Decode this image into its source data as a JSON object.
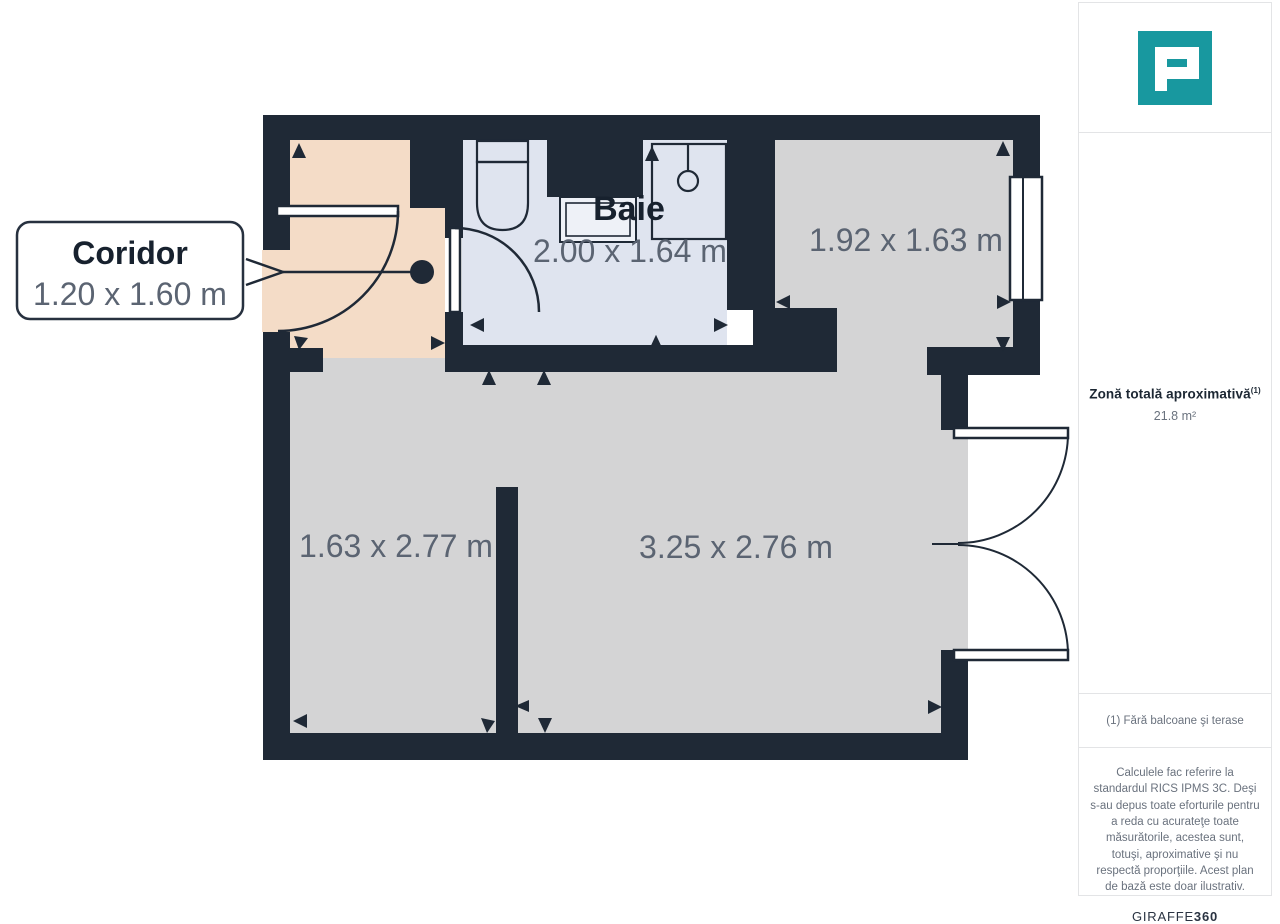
{
  "plan": {
    "callout": {
      "title": "Coridor",
      "dims": "1.20 x 1.60 m"
    },
    "rooms": {
      "baie": {
        "label": "Baie",
        "dims": "2.00 x 1.64 m"
      },
      "top_right": {
        "dims": "1.92 x 1.63 m"
      },
      "left": {
        "dims": "1.63 x 2.77 m"
      },
      "main": {
        "dims": "3.25 x 2.76 m"
      }
    },
    "colors": {
      "wall": "#1f2936",
      "corridor_floor": "#f4dcc7",
      "bathroom_floor": "#dfe4ef",
      "room_floor": "#d4d4d5",
      "dim_text": "#5b6472",
      "label_text": "#17212e"
    }
  },
  "sidebar": {
    "logo": "P-mark",
    "accent_color": "#18989f",
    "total_area": {
      "title": "Zonă totală aproximativă",
      "superscript": "(1)",
      "value": "21.8 m²"
    },
    "footnote": "(1) Fără balcoane şi terase",
    "disclaimer": "Calculele fac referire la standardul RICS IPMS 3C. Deşi s-au depus toate eforturile pentru a reda cu acurateţe toate măsurătorile, acestea sunt, totuşi, aproximative şi nu respectă proporţiile. Acest plan de bază este doar ilustrativ.",
    "brand": {
      "name": "GIRAFFE",
      "number": "360"
    }
  }
}
